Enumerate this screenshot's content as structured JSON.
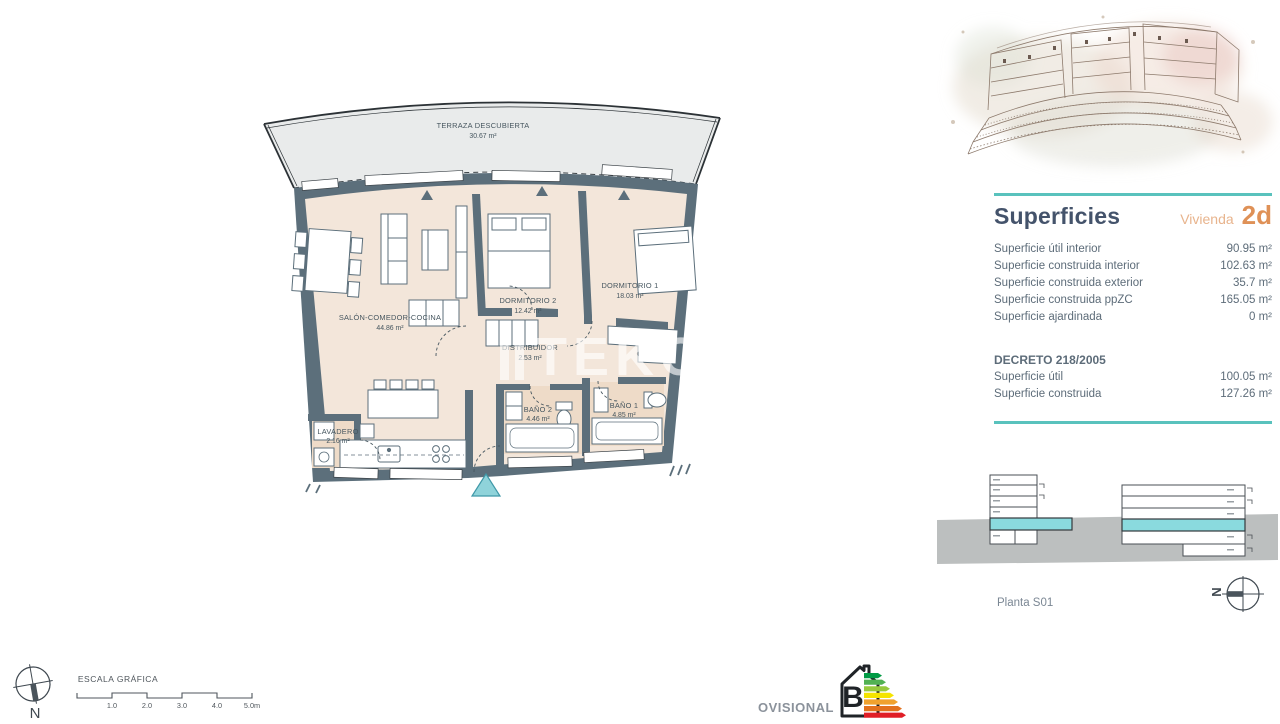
{
  "plan": {
    "rooms": [
      {
        "label": "TERRAZA DESCUBIERTA",
        "area": "30.67 m²"
      },
      {
        "label": "SALÓN-COMEDOR-COCINA",
        "area": "44.86 m²"
      },
      {
        "label": "DORMITORIO 2",
        "area": "12.42 m²"
      },
      {
        "label": "DORMITORIO 1",
        "area": "18.03 m²"
      },
      {
        "label": "DISTRIBUIDOR",
        "area": "2.53 m²"
      },
      {
        "label": "BAÑO 2",
        "area": "4.46 m²"
      },
      {
        "label": "BAÑO 1",
        "area": "4.85 m²"
      },
      {
        "label": "LAVADERO",
        "area": "2.16 m²"
      }
    ],
    "watermark": "TEKCE"
  },
  "sidebar": {
    "title": "Superficies",
    "unit_label": "Vivienda",
    "unit_code": "2d",
    "superficies_rows": [
      {
        "label": "Superficie útil interior",
        "value": "90.95 m²"
      },
      {
        "label": "Superficie construida interior",
        "value": "102.63 m²"
      },
      {
        "label": "Superficie construida exterior",
        "value": "35.7 m²"
      },
      {
        "label": "Superficie construida ppZC",
        "value": "165.05 m²"
      },
      {
        "label": "Superficie ajardinada",
        "value": "0 m²"
      }
    ],
    "decreto_title": "DECRETO 218/2005",
    "decreto_rows": [
      {
        "label": "Superficie útil",
        "value": "100.05 m²"
      },
      {
        "label": "Superficie construida",
        "value": "127.26 m²"
      }
    ],
    "plant_label": "Planta S01",
    "compass_letter": "N"
  },
  "footer": {
    "scale_title": "ESCALA GRÁFICA",
    "scale_ticks": [
      "1.0",
      "2.0",
      "3.0",
      "4.0",
      "5.0m"
    ],
    "compass_letter": "N",
    "provisional_label": "PROVISIONAL",
    "energy_rating": "B"
  },
  "colors": {
    "accent_teal": "#59c2bd",
    "accent_orange": "#df9157",
    "wall_slate": "#5c6f7b",
    "floor_beige": "#f3e6da",
    "floor_tan": "#eedbc8",
    "terrace_gray": "#e9ebeb",
    "highlight_cyan": "#8adade",
    "entrance_cyan": "#8fd3da",
    "energy_bars": [
      "#009a44",
      "#52b153",
      "#97c93d",
      "#f5e400",
      "#f0a22e",
      "#e2711d",
      "#e01e26"
    ]
  }
}
